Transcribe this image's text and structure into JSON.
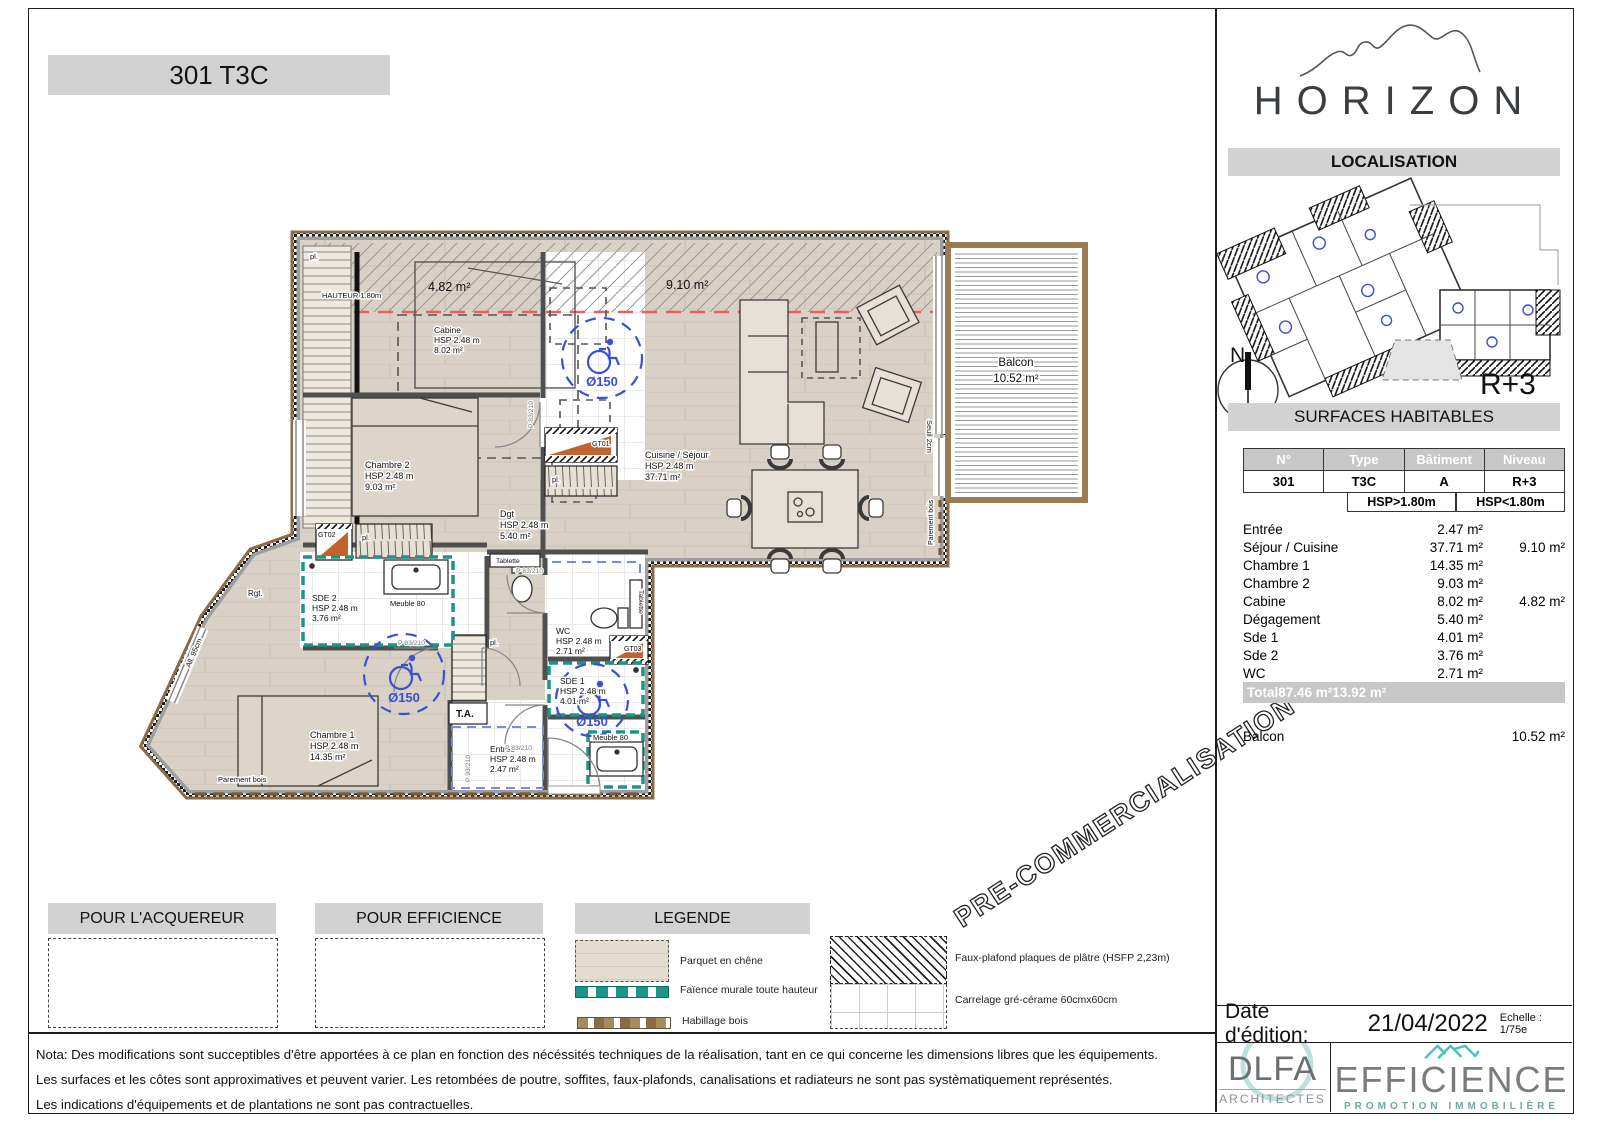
{
  "title": "301 T3C",
  "brand": {
    "name": "HORIZON"
  },
  "right_panel": {
    "localisation_header": "LOCALISATION",
    "level_label": "R+3",
    "compass_north": "N",
    "surfaces_header": "SURFACES HABITABLES",
    "table": {
      "hdr": [
        "N°",
        "Type",
        "Bâtiment",
        "Niveau"
      ],
      "unit": [
        "301",
        "T3C",
        "A",
        "R+3"
      ],
      "hsp": [
        "HSP>1.80m",
        "HSP<1.80m"
      ],
      "rows": [
        {
          "name": "Entrée",
          "a": "2.47 m²",
          "b": ""
        },
        {
          "name": "Séjour / Cuisine",
          "a": "37.71 m²",
          "b": "9.10 m²"
        },
        {
          "name": "Chambre 1",
          "a": "14.35 m²",
          "b": ""
        },
        {
          "name": "Chambre 2",
          "a": "9.03 m²",
          "b": ""
        },
        {
          "name": "Cabine",
          "a": "8.02 m²",
          "b": "4.82 m²"
        },
        {
          "name": "Dégagement",
          "a": "5.40 m²",
          "b": ""
        },
        {
          "name": "Sde 1",
          "a": "4.01 m²",
          "b": ""
        },
        {
          "name": "Sde 2",
          "a": "3.76 m²",
          "b": ""
        },
        {
          "name": "WC",
          "a": "2.71 m²",
          "b": ""
        }
      ],
      "total": {
        "label": "Total",
        "a": "87.46 m²",
        "b": "13.92 m²"
      },
      "balcon": {
        "label": "Balcon",
        "value": "10.52 m²"
      }
    },
    "date_row": {
      "label": "Date d'édition:",
      "value": "21/04/2022",
      "scale": "Echelle : 1/75e"
    }
  },
  "plan": {
    "rooms": {
      "cabine": {
        "name": "Cabine",
        "hsp": "HSP 2.48 m",
        "area": "8.02 m²"
      },
      "chambre2": {
        "name": "Chambre 2",
        "hsp": "HSP 2.48 m",
        "area": "9.03 m²"
      },
      "sejour": {
        "name": "Cuisine / Séjour",
        "hsp": "HSP 2.48 m",
        "area": "37.71 m²"
      },
      "dgt": {
        "name": "Dgt",
        "hsp": "HSP 2.48 m",
        "area": "5.40 m²"
      },
      "sde2": {
        "name": "SDE 2",
        "hsp": "HSP 2.48 m",
        "area": "3.76 m²"
      },
      "wc": {
        "name": "WC",
        "hsp": "HSP 2.48 m",
        "area": "2.71 m²"
      },
      "sde1": {
        "name": "SDE 1",
        "hsp": "HSP 2.48 m",
        "area": "4.01 m²"
      },
      "chambre1": {
        "name": "Chambre 1",
        "hsp": "HSP 2.48 m",
        "area": "14.35 m²"
      },
      "entree": {
        "name": "Entrée",
        "hsp": "HSP 2.48 m",
        "area": "2.47 m²"
      }
    },
    "annotations": {
      "zone_cabine": "4.82 m²",
      "zone_sejour": "9.10 m²",
      "hauteur": "HAUTEUR 1.80m",
      "balcon_name": "Balcon",
      "balcon_area": "10.52 m²",
      "seuil": "Seuil 2cm",
      "parement": "Parement bois",
      "allege": "All. 95cm",
      "ta": "T.A.",
      "tablette": "Tablette",
      "meuble": "Meuble 80",
      "pl": "pl.",
      "rgt": "Rgt.",
      "gt01": "GT01",
      "gt02": "GT02",
      "gt03": "GT03",
      "door83": "P 83/210",
      "door93": "P 93/210",
      "diam": "Ø150"
    },
    "watermark": "PRE-COMMERCIALISATION"
  },
  "legend": {
    "header": "LEGENDE",
    "acquereur_header": "POUR L'ACQUEREUR",
    "efficience_header": "POUR EFFICIENCE",
    "items": [
      "Parquet en chêne",
      "Faïence murale toute hauteur",
      "Habillage bois",
      "Faux-plafond plaques de plâtre (HSFP 2,23m)",
      "Carrelage gré-cérame 60cmx60cm"
    ]
  },
  "nota": {
    "lines": [
      "Nota: Des modifications sont succeptibles d'être apportées à ce plan en fonction des nécéssités techniques de la réalisation, tant en ce qui concerne les dimensions libres que les équipements.",
      "Les surfaces et les côtes sont approximatives et peuvent varier. Les retombées de poutre, soffites, faux-plafonds, canalisations et radiateurs ne sont pas systèmatiquement représentés.",
      "Les indications d'équipements et de plantations ne sont pas contractuelles."
    ]
  },
  "footer": {
    "dlfa": {
      "name": "DLFA",
      "sub": "ARCHITECTES"
    },
    "efficience": {
      "name": "EFFICIENCE",
      "sub": "PROMOTION IMMOBILIÈRE"
    }
  },
  "colors": {
    "teal": "#1d9488",
    "orange": "#c2632e",
    "blue": "#3b4fd4",
    "red_dash": "#e86060",
    "wood": "#d9d1c6",
    "wall_gray": "#9e9e9e",
    "balcony_wood": "#9a7b52"
  }
}
